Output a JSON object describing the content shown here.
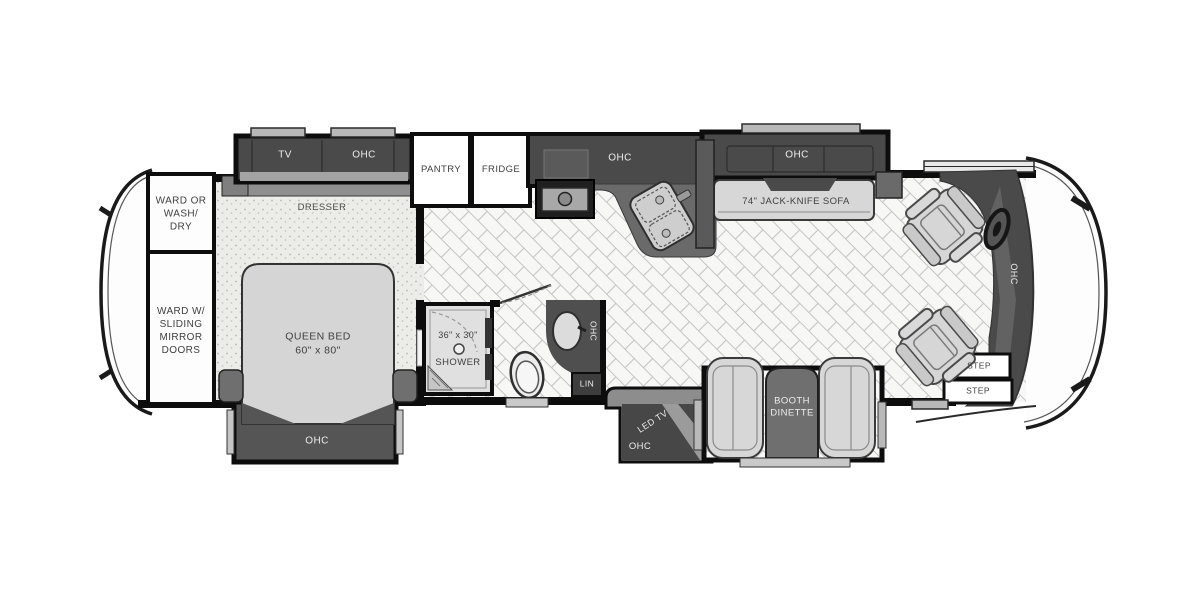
{
  "plan": {
    "bedroom": {
      "ward_top": "WARD OR\nWASH/\nDRY",
      "ward_bottom": "WARD W/\nSLIDING\nMIRROR\nDOORS",
      "tv": "TV",
      "ohc_overhead": "OHC",
      "dresser": "DRESSER",
      "queen_bed": "QUEEN BED\n60\" x 80\"",
      "ohc_foot": "OHC"
    },
    "kitchen": {
      "pantry": "PANTRY",
      "fridge": "FRIDGE",
      "ohc": "OHC"
    },
    "bathroom": {
      "shower_size": "36\" x 30\"",
      "shower": "SHOWER",
      "ohc": "OHC",
      "linen": "LIN"
    },
    "living": {
      "ohc_sofa": "OHC",
      "sofa": "74\" JACK-KNIFE SOFA",
      "led_tv": "LED TV",
      "ohc_tv_cabinet": "OHC",
      "booth_dinette": "BOOTH\nDINETTE"
    },
    "entry": {
      "step_upper": "STEP",
      "step_lower": "STEP"
    },
    "cockpit": {
      "ohc": "OHC"
    }
  },
  "colors": {
    "wall": "#0d0d0d",
    "cabinet_dark": "#4a4a4a",
    "cabinet_mid": "#6f6f6f",
    "furniture_light": "#d6d6d6",
    "tile_line": "#c5c5c5",
    "carpet": "#ecece9",
    "text_dark": "#3f3f3f",
    "text_light": "#ececec"
  }
}
